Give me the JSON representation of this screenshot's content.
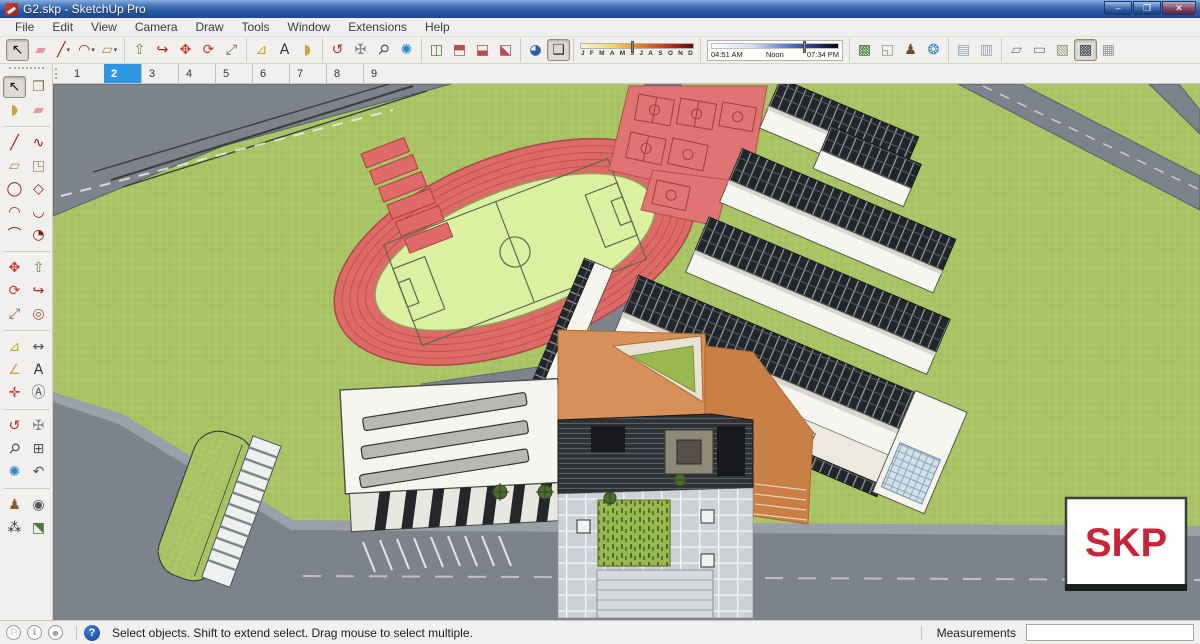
{
  "window": {
    "title": "G2.skp - SketchUp Pro",
    "controls": {
      "minimize": "–",
      "restore": "❐",
      "close": "✕"
    }
  },
  "menubar": {
    "items": [
      "File",
      "Edit",
      "View",
      "Camera",
      "Draw",
      "Tools",
      "Window",
      "Extensions",
      "Help"
    ]
  },
  "toolbar": {
    "segments": [
      {
        "type": "tools",
        "name": "principal",
        "tools": [
          {
            "name": "select-tool",
            "glyph": "↖",
            "color": "#111111",
            "pressed": true
          },
          {
            "name": "eraser-tool",
            "glyph": "▰",
            "color": "#e598a6"
          },
          {
            "name": "line-tool",
            "glyph": "╱",
            "color": "#8c1a13",
            "dropdown": true
          },
          {
            "name": "arc-tool",
            "glyph": "◠",
            "color": "#8c1a13",
            "dropdown": true
          },
          {
            "name": "rectangle-tool",
            "glyph": "▱",
            "color": "#a8895a",
            "dropdown": true
          }
        ]
      },
      {
        "type": "tools",
        "name": "edit",
        "tools": [
          {
            "name": "push-pull-tool",
            "glyph": "⇧",
            "color": "#7a7a4a"
          },
          {
            "name": "follow-me-tool",
            "glyph": "↪",
            "color": "#a8231a"
          },
          {
            "name": "move-tool",
            "glyph": "✥",
            "color": "#c0392b"
          },
          {
            "name": "rotate-tool",
            "glyph": "⟳",
            "color": "#c0392b"
          },
          {
            "name": "scale-tool",
            "glyph": "⤢",
            "color": "#8a5a2a"
          }
        ]
      },
      {
        "type": "tools",
        "name": "construction",
        "tools": [
          {
            "name": "tape-measure-tool",
            "glyph": "⊿",
            "color": "#c9a227"
          },
          {
            "name": "text-tool",
            "glyph": "A",
            "color": "#333333"
          },
          {
            "name": "paint-bucket-tool",
            "glyph": "◗",
            "color": "#caa53f"
          }
        ]
      },
      {
        "type": "tools",
        "name": "camera",
        "tools": [
          {
            "name": "orbit-tool",
            "glyph": "↺",
            "color": "#b03030"
          },
          {
            "name": "pan-tool",
            "glyph": "✠",
            "color": "#7f8c8d"
          },
          {
            "name": "zoom-tool",
            "glyph": "⚲",
            "color": "#555555",
            "rot": true
          },
          {
            "name": "zoom-extents-tool",
            "glyph": "✺",
            "color": "#2e86c1"
          }
        ]
      },
      {
        "type": "tools",
        "name": "section",
        "tools": [
          {
            "name": "section-plane-tool",
            "glyph": "◫",
            "color": "#4a7a3a"
          },
          {
            "name": "display-section-planes-toggle",
            "glyph": "⬒",
            "color": "#b05050"
          },
          {
            "name": "display-section-cuts-toggle",
            "glyph": "⬓",
            "color": "#b05050"
          },
          {
            "name": "display-section-fill-toggle",
            "glyph": "⬕",
            "color": "#b05050"
          }
        ]
      },
      {
        "type": "tools",
        "name": "shadow",
        "tools": [
          {
            "name": "shadow-settings-dialog",
            "glyph": "◕",
            "color": "#2e5fa3"
          },
          {
            "name": "shadows-toggle",
            "glyph": "❏",
            "color": "#333333",
            "pressed": true
          }
        ]
      },
      {
        "type": "month-slider"
      },
      {
        "type": "time-slider"
      },
      {
        "type": "tools",
        "name": "location",
        "tools": [
          {
            "name": "add-location",
            "glyph": "▩",
            "color": "#4a7a3a"
          },
          {
            "name": "toggle-terrain",
            "glyph": "◱",
            "color": "#9a9a94"
          },
          {
            "name": "photo-textures",
            "glyph": "♟",
            "color": "#6b4f2a"
          },
          {
            "name": "preview-in-google-earth",
            "glyph": "❂",
            "color": "#2e86c1"
          }
        ]
      },
      {
        "type": "tools",
        "name": "style-edges",
        "tools": [
          {
            "name": "x-ray-style",
            "glyph": "▤",
            "color": "#8fa7b9"
          },
          {
            "name": "back-edges-style",
            "glyph": "▥",
            "color": "#8fa7b9"
          }
        ]
      },
      {
        "type": "tools",
        "name": "face-styles",
        "tools": [
          {
            "name": "wireframe-style",
            "glyph": "▱",
            "color": "#777777"
          },
          {
            "name": "hidden-line-style",
            "glyph": "▭",
            "color": "#777777"
          },
          {
            "name": "shaded-style",
            "glyph": "▧",
            "color": "#8a9a6a"
          },
          {
            "name": "shaded-with-textures-style",
            "glyph": "▩",
            "color": "#3a4a5a",
            "pressed": true
          },
          {
            "name": "monochrome-style",
            "glyph": "▦",
            "color": "#999999"
          }
        ]
      }
    ]
  },
  "shadow": {
    "months": [
      "J",
      "F",
      "M",
      "A",
      "M",
      "J",
      "J",
      "A",
      "S",
      "O",
      "N",
      "D"
    ],
    "month_thumb_pct": 45,
    "time_start": "04:51 AM",
    "time_mid": "Noon",
    "time_end": "07:34 PM",
    "time_thumb_pct": 72
  },
  "scene_tabs": {
    "tabs": [
      "1",
      "2",
      "3",
      "4",
      "5",
      "6",
      "7",
      "8",
      "9"
    ],
    "active": "2"
  },
  "palette": {
    "separators_after": [
      3,
      13,
      19,
      25,
      31
    ],
    "items": [
      {
        "name": "select-tool",
        "glyph": "↖",
        "color": "#111111",
        "pressed": true
      },
      {
        "name": "make-component-tool",
        "glyph": "❐",
        "color": "#8a7a5a"
      },
      {
        "name": "paint-bucket-tool",
        "glyph": "◗",
        "color": "#caa53f"
      },
      {
        "name": "eraser-tool",
        "glyph": "▰",
        "color": "#e598a6"
      },
      {
        "name": "line-tool",
        "glyph": "╱",
        "color": "#8c1a13"
      },
      {
        "name": "freehand-tool",
        "glyph": "∿",
        "color": "#8c1a13"
      },
      {
        "name": "rectangle-tool",
        "glyph": "▱",
        "color": "#a8895a"
      },
      {
        "name": "rotated-rectangle-tool",
        "glyph": "◳",
        "color": "#a8895a"
      },
      {
        "name": "circle-tool",
        "glyph": "◯",
        "color": "#8c1a13"
      },
      {
        "name": "polygon-tool",
        "glyph": "◇",
        "color": "#8c1a13"
      },
      {
        "name": "arc-tool",
        "glyph": "◠",
        "color": "#8c1a13"
      },
      {
        "name": "two-point-arc-tool",
        "glyph": "◡",
        "color": "#8c1a13"
      },
      {
        "name": "three-point-arc-tool",
        "glyph": "⌒",
        "color": "#8c1a13"
      },
      {
        "name": "pie-tool",
        "glyph": "◔",
        "color": "#8c1a13"
      },
      {
        "name": "move-tool",
        "glyph": "✥",
        "color": "#c0392b"
      },
      {
        "name": "push-pull-tool",
        "glyph": "⇧",
        "color": "#7a7a4a"
      },
      {
        "name": "rotate-tool",
        "glyph": "⟳",
        "color": "#c0392b"
      },
      {
        "name": "follow-me-tool",
        "glyph": "↪",
        "color": "#a8231a"
      },
      {
        "name": "scale-tool",
        "glyph": "⤢",
        "color": "#8a5a2a"
      },
      {
        "name": "offset-tool",
        "glyph": "◎",
        "color": "#8a5a2a"
      },
      {
        "name": "tape-measure-tool",
        "glyph": "⊿",
        "color": "#c9a227"
      },
      {
        "name": "dimension-tool",
        "glyph": "↔",
        "color": "#555555"
      },
      {
        "name": "protractor-tool",
        "glyph": "∠",
        "color": "#caa53f"
      },
      {
        "name": "text-tool",
        "glyph": "A",
        "color": "#333333"
      },
      {
        "name": "axes-tool",
        "glyph": "✛",
        "color": "#c0392b"
      },
      {
        "name": "3d-text-tool",
        "glyph": "Ⓐ",
        "color": "#555555"
      },
      {
        "name": "orbit-tool",
        "glyph": "↺",
        "color": "#b03030"
      },
      {
        "name": "pan-tool",
        "glyph": "✠",
        "color": "#7f8c8d"
      },
      {
        "name": "zoom-tool",
        "glyph": "⚲",
        "color": "#555555",
        "rot": true
      },
      {
        "name": "zoom-window-tool",
        "glyph": "⊞",
        "color": "#555555"
      },
      {
        "name": "zoom-extents-tool",
        "glyph": "✺",
        "color": "#2e86c1"
      },
      {
        "name": "previous-view-tool",
        "glyph": "↶",
        "color": "#555555"
      },
      {
        "name": "position-camera-tool",
        "glyph": "♟",
        "color": "#8a5a2a"
      },
      {
        "name": "look-around-tool",
        "glyph": "◉",
        "color": "#555555"
      },
      {
        "name": "walk-tool",
        "glyph": "⁂",
        "color": "#333333"
      },
      {
        "name": "section-plane-tool",
        "glyph": "⬔",
        "color": "#4a7a3a"
      }
    ]
  },
  "statusbar": {
    "icons": [
      {
        "name": "geolocation-status-icon",
        "glyph": "⚐"
      },
      {
        "name": "credit-attribution-icon",
        "glyph": "ℹ"
      },
      {
        "name": "sign-in-icon",
        "glyph": "☻"
      }
    ],
    "help_glyph": "?",
    "message": "Select objects. Shift to extend select. Drag mouse to select multiple.",
    "measurements_label": "Measurements",
    "measurements_value": ""
  },
  "viewport": {
    "watermark": "SKP",
    "colors": {
      "grass": "#a9c465",
      "road": "#7d838d",
      "roadlight": "#9aa0a8",
      "track": "#dd6a66",
      "tracklane": "#bf5250",
      "field": "#dcf0a2",
      "court": "#e07473",
      "roof": "#f6f5ef",
      "facade": "#33373a",
      "orange": "#d79058",
      "orange2": "#c97f46",
      "plaza": "#ccd1d6",
      "planter": "#9ab84e",
      "skpred": "#c9243a"
    }
  }
}
